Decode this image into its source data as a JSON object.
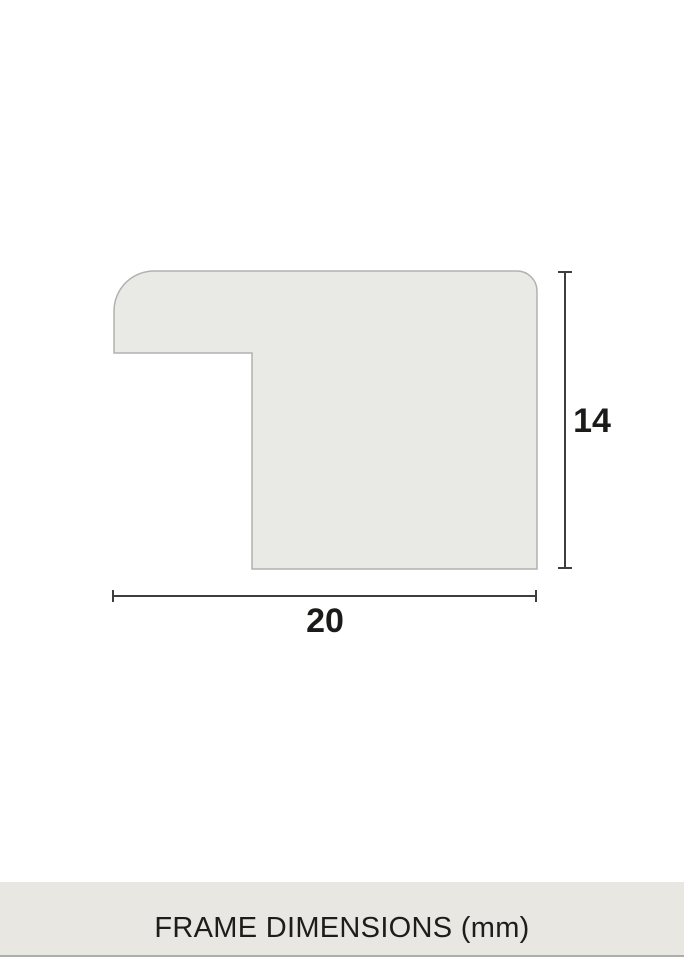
{
  "diagram": {
    "height_label": "14",
    "width_label": "20",
    "caption": "FRAME DIMENSIONS (mm)"
  },
  "colors": {
    "background": "#ffffff",
    "profile_fill": "#e9e9e5",
    "profile_stroke": "#b1b1ae",
    "dimension_line": "#3e3e3e",
    "dimension_text": "#1b1b1a",
    "caption_band_bg": "#e8e7e2",
    "caption_text": "#1d1d1b",
    "bottom_edge": "#adadab"
  }
}
